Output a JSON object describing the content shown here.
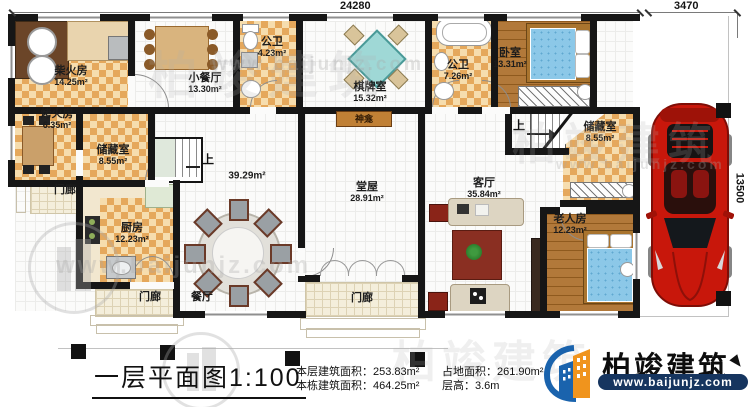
{
  "plan": {
    "type": "residential-first-floor-plan"
  },
  "dimensions": {
    "top_width": "24280",
    "carport_width": "3470",
    "right_height": "13500"
  },
  "rooms": {
    "chaihuofang": {
      "name": "柴火房",
      "area": "14.25m²"
    },
    "kaohuofang": {
      "name": "烤火房",
      "area": "6.35m²"
    },
    "chucangshi_left": {
      "name": "储藏室",
      "area": "8.55m²"
    },
    "chufang": {
      "name": "厨房",
      "area": "12.23m²"
    },
    "xiaocanting": {
      "name": "小餐厅",
      "area": "13.30m²"
    },
    "gongwei_top": {
      "name": "公卫",
      "area": "4.23m²"
    },
    "qipaishi": {
      "name": "棋牌室",
      "area": "15.32m²"
    },
    "gongwei_right": {
      "name": "公卫",
      "area": "7.26m²"
    },
    "woshi": {
      "name": "卧室",
      "area": "13.31m²"
    },
    "chucangshi_right": {
      "name": "储藏室",
      "area": "8.55m²"
    },
    "tangwu": {
      "name": "堂屋",
      "area": "28.91m²"
    },
    "keting": {
      "name": "客厅",
      "area": "35.84m²"
    },
    "laorenfang": {
      "name": "老人房",
      "area": "12.23m²"
    },
    "canting": {
      "name": "餐厅"
    },
    "hall": {
      "area": "39.29m²"
    }
  },
  "labels": {
    "porch": "门廊",
    "shrine": "神龛",
    "up": "上"
  },
  "title_block": {
    "title": "一层平面图",
    "scale": "1:100",
    "stats": [
      {
        "label": "本层建筑面积：",
        "value": "253.83m²"
      },
      {
        "label": "本栋建筑面积：",
        "value": "464.25m²"
      },
      {
        "label": "占地面积：",
        "value": "261.90m²"
      },
      {
        "label": "层高：",
        "value": "3.6m"
      }
    ]
  },
  "logo": {
    "brand": "柏竣建筑",
    "url": "www.baijunjz.com"
  },
  "watermark": {
    "brand": "柏竣建筑",
    "url": "www.baijunjz.com"
  },
  "colors": {
    "wall": "#161616",
    "checker_tile": "#e5a85c",
    "wood_floor": "#b2793a",
    "mattress_blue": "#8cc8e8",
    "car_red": "#c8170b",
    "logo_blue": "#1a63ad",
    "logo_orange": "#f0941d",
    "rug_red": "#8a2f22"
  }
}
